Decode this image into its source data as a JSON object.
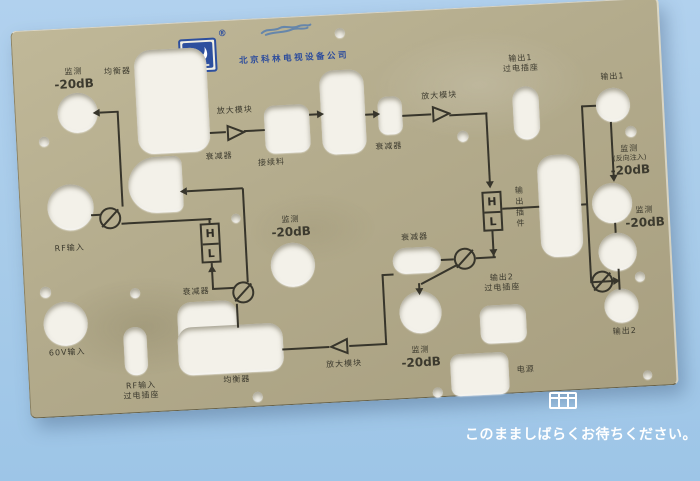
{
  "colors": {
    "background_blue": "#a7cbe9",
    "panel_beige": "#b3ab8c",
    "ink": "#37352b",
    "logo_blue": "#2d4f9e",
    "hole_white": "#f3f1e9",
    "overlay_text": "#ffffff"
  },
  "logo": {
    "registered": "®",
    "company": "北京科林电视设备公司"
  },
  "labels": {
    "monitor": "监测",
    "minus20db": "-20dB",
    "reverse_injection": "(反向注入)",
    "equalizer": "均衡器",
    "attenuator": "衰减器",
    "amplifier_module": "放大模块",
    "splice_part": "接续料",
    "output1": "输出1",
    "output2": "输出2",
    "feedthrough_socket": "过电插座",
    "rf_input": "RF输入",
    "input_60v": "60V输入",
    "power": "电源",
    "output_plugin": "输出插件",
    "filter_high": "H",
    "filter_low": "L"
  },
  "overlay": {
    "wait_message": "このまましばらくお待ちください。"
  }
}
